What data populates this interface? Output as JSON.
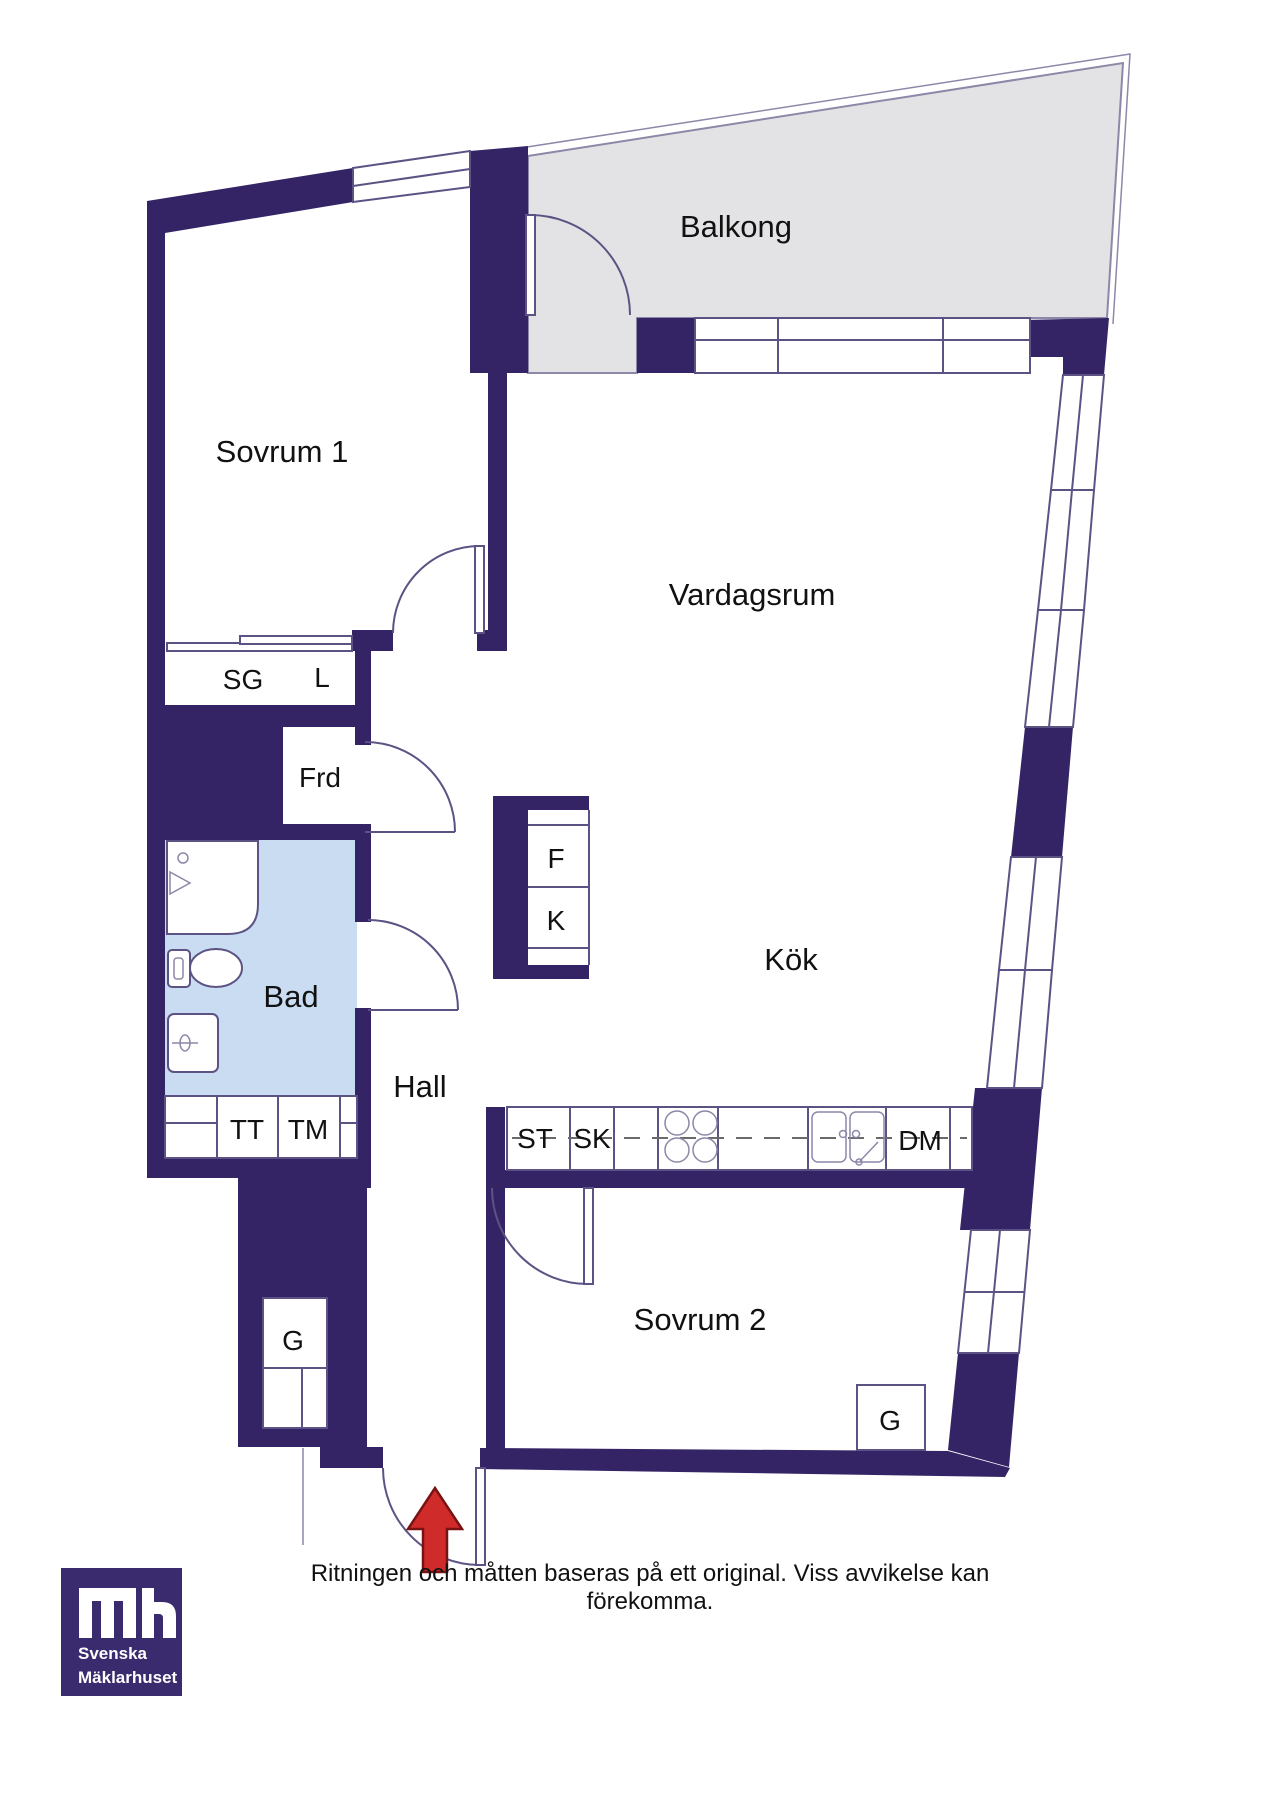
{
  "floorplan": {
    "rooms": {
      "sovrum1": "Sovrum 1",
      "balkong": "Balkong",
      "vardagsrum": "Vardagsrum",
      "kok": "Kök",
      "hall": "Hall",
      "bad": "Bad",
      "sovrum2": "Sovrum 2"
    },
    "fixtures": {
      "sg": "SG",
      "l": "L",
      "frd": "Frd",
      "fridge": "F",
      "freezer": "K",
      "tt": "TT",
      "tm": "TM",
      "st": "ST",
      "sk": "SK",
      "dm": "DM",
      "g_hall": "G",
      "g_sovrum2": "G"
    },
    "colors": {
      "wall": "#342466",
      "outline": "#5c5384",
      "balcony_floor": "#e3e3e5",
      "bathroom_floor": "#c9dcf1",
      "entrance_arrow": "#cf2b2b"
    }
  },
  "footer": {
    "disclaimer": "Ritningen och måtten baseras på ett original. Viss avvikelse kan förekomma."
  },
  "logo": {
    "monogram": "mh",
    "name_line1": "Svenska",
    "name_line2": "Mäklarhuset"
  }
}
